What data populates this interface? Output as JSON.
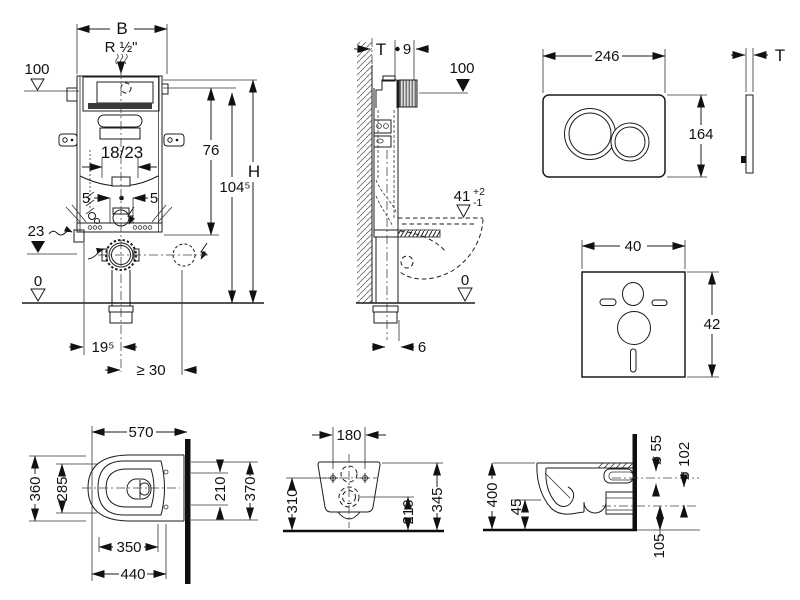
{
  "colors": {
    "line": "#1c1c1c",
    "background": "#ffffff",
    "wall_fill": "#101010"
  },
  "front_view": {
    "b": "B",
    "supply": "R ½\"",
    "datum100": "100",
    "adj": "18/23",
    "h76": "76",
    "h104": "104⁵",
    "h": "H",
    "five_l": "5",
    "five_r": "5",
    "datum23": "23",
    "datum0": "0",
    "d195": "19⁵",
    "dmin30": "≥ 30"
  },
  "side_view": {
    "t": "T",
    "d9": "9",
    "datum100": "100",
    "seat": "41",
    "tol_plus": "+2",
    "tol_minus": "-1",
    "datum0": "0",
    "d6": "6"
  },
  "flush_plate": {
    "width": "246",
    "height": "164",
    "thickness": "T"
  },
  "sound_pad": {
    "width": "40",
    "height": "42"
  },
  "wc_top_view": {
    "d570": "570",
    "d360": "360",
    "d285": "285",
    "d350": "350",
    "d440": "440",
    "d210": "210",
    "d370": "370"
  },
  "wc_rear_view": {
    "d180": "180",
    "d310": "310",
    "d210": "210",
    "d345": "345"
  },
  "wc_side_view": {
    "d400": "400",
    "d45": "45",
    "d55": "ø 55",
    "d102": "ø 102",
    "d105": "105"
  }
}
